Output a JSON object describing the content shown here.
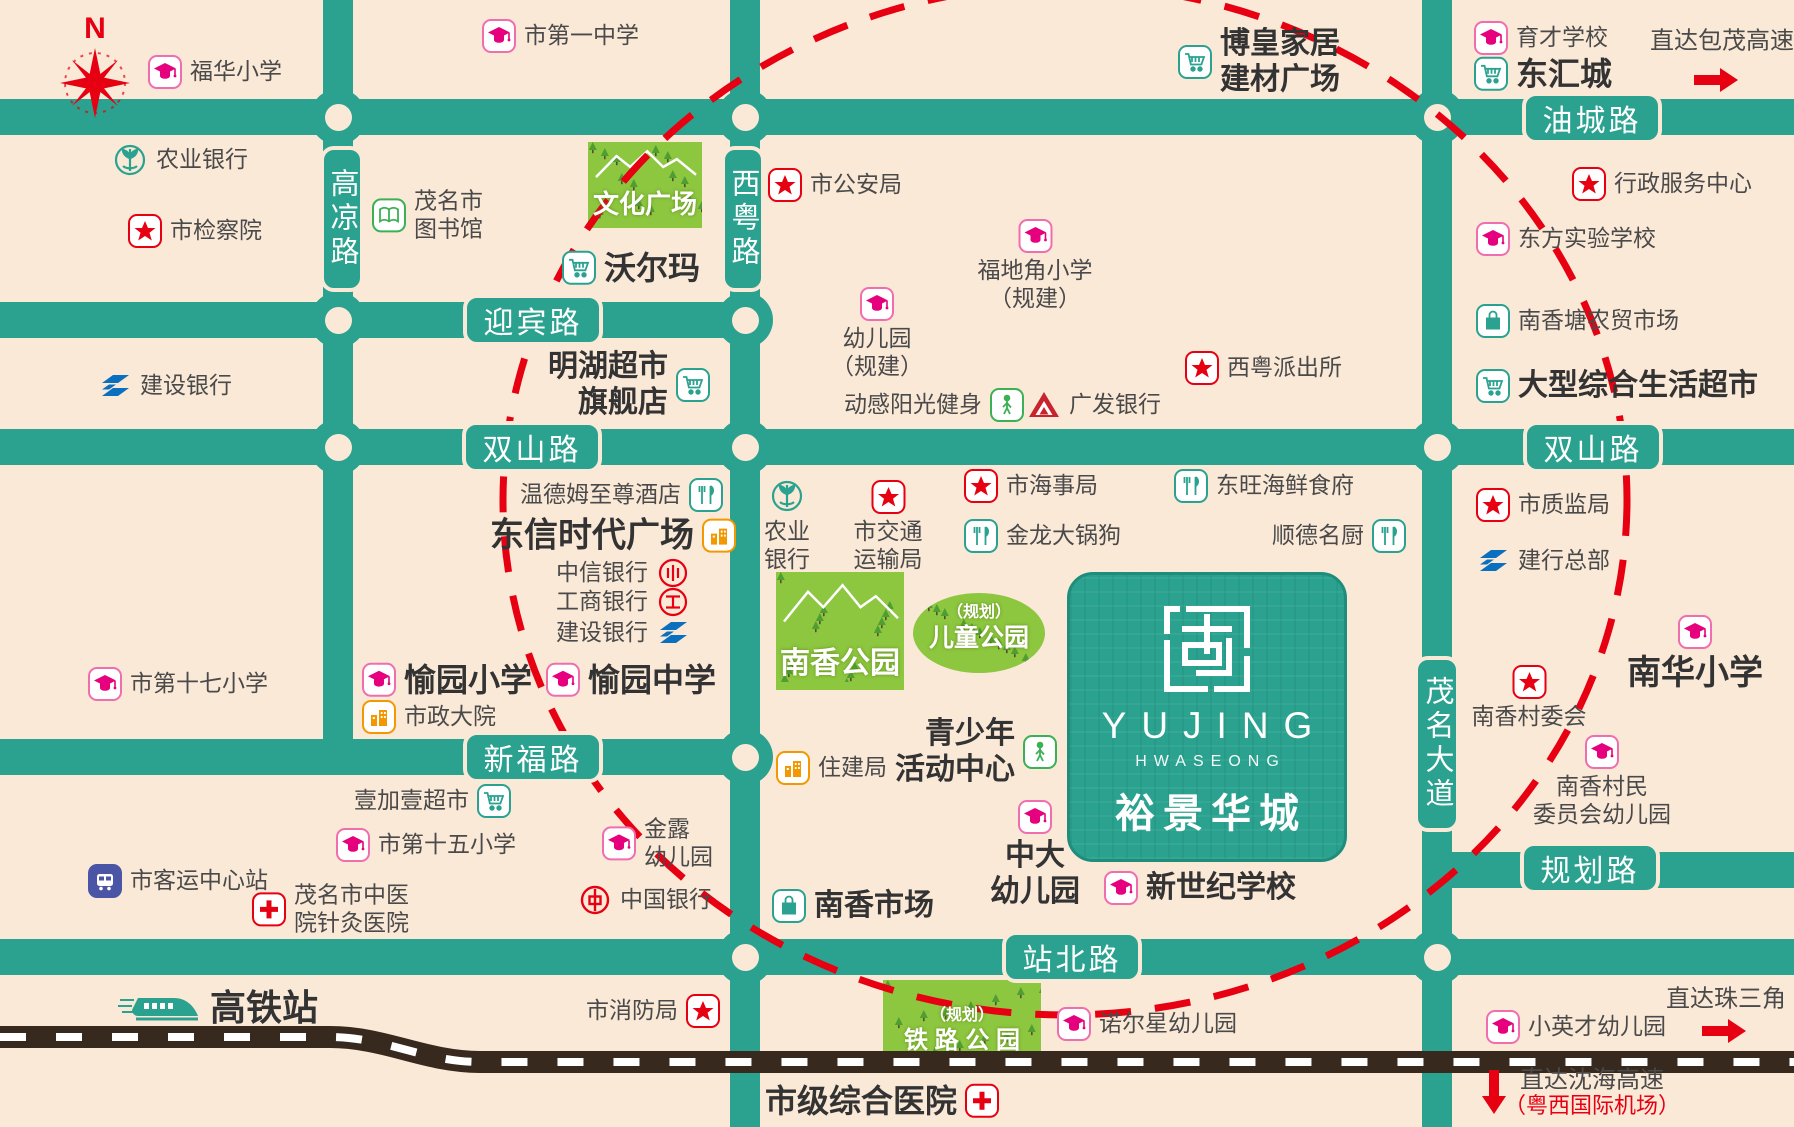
{
  "canvas": {
    "width": 1794,
    "height": 1127,
    "bg": "#fbe9d8",
    "road_color": "#2aa28f",
    "accent_red": "#e60012",
    "park_green": "#8dc63f"
  },
  "compass": {
    "label": "N"
  },
  "roads": {
    "horizontal": [
      {
        "name": "油城路",
        "x": 0,
        "y": 99,
        "w": 1794,
        "h": 36
      },
      {
        "name": "迎宾路",
        "x": 0,
        "y": 302,
        "w": 760,
        "h": 36
      },
      {
        "name": "双山路",
        "x": 0,
        "y": 429,
        "w": 1794,
        "h": 36
      },
      {
        "name": "新福路",
        "x": 0,
        "y": 739,
        "w": 760,
        "h": 36
      },
      {
        "name": "规划路",
        "x": 1422,
        "y": 852,
        "w": 372,
        "h": 36
      },
      {
        "name": "站北路",
        "x": 0,
        "y": 939,
        "w": 1794,
        "h": 36
      }
    ],
    "vertical": [
      {
        "name": "高凉路",
        "x": 323,
        "y": 0,
        "w": 30,
        "h": 775
      },
      {
        "name": "西粤路",
        "x": 730,
        "y": 0,
        "w": 30,
        "h": 1127
      },
      {
        "name": "茂名大道",
        "x": 1422,
        "y": 0,
        "w": 30,
        "h": 1127
      }
    ]
  },
  "road_badges": [
    {
      "label": "油城路",
      "x": 1522,
      "y": 92,
      "w": 140,
      "h": 52,
      "vertical": false
    },
    {
      "label": "迎宾路",
      "x": 463,
      "y": 294,
      "w": 140,
      "h": 52,
      "vertical": false
    },
    {
      "label": "双山路",
      "x": 462,
      "y": 421,
      "w": 140,
      "h": 52,
      "vertical": false
    },
    {
      "label": "双山路",
      "x": 1523,
      "y": 421,
      "w": 140,
      "h": 52,
      "vertical": false
    },
    {
      "label": "新福路",
      "x": 463,
      "y": 731,
      "w": 140,
      "h": 52,
      "vertical": false
    },
    {
      "label": "规划路",
      "x": 1520,
      "y": 842,
      "w": 140,
      "h": 52,
      "vertical": false
    },
    {
      "label": "站北路",
      "x": 1002,
      "y": 931,
      "w": 140,
      "h": 52,
      "vertical": false
    },
    {
      "label": "高凉路",
      "x": 320,
      "y": 146,
      "w": 44,
      "h": 146,
      "vertical": true
    },
    {
      "label": "西粤路",
      "x": 721,
      "y": 146,
      "w": 44,
      "h": 146,
      "vertical": true
    },
    {
      "label": "茂名大道",
      "x": 1414,
      "y": 656,
      "w": 46,
      "h": 176,
      "vertical": true
    }
  ],
  "junctions": [
    [
      338,
      117
    ],
    [
      745,
      117
    ],
    [
      1437,
      117
    ],
    [
      338,
      320
    ],
    [
      745,
      320
    ],
    [
      338,
      447
    ],
    [
      745,
      447
    ],
    [
      1437,
      447
    ],
    [
      745,
      757
    ],
    [
      745,
      957
    ],
    [
      1437,
      957
    ]
  ],
  "highlight_circle": {
    "cx": 1065,
    "cy": 500,
    "rx": 562,
    "ry": 515
  },
  "railway": {
    "path": "M0,1037 H330 C385,1037 425,1062 480,1062 H1794"
  },
  "parks": [
    {
      "name": "culture-square-park",
      "shape": "rect",
      "x": 588,
      "y": 142,
      "w": 114,
      "h": 78,
      "lines": [
        "文化广场"
      ],
      "sizes": [
        26
      ],
      "mountains": true
    },
    {
      "name": "nanxiang-park",
      "shape": "rect",
      "x": 776,
      "y": 572,
      "w": 128,
      "h": 110,
      "lines": [
        "南香公园"
      ],
      "sizes": [
        30
      ],
      "mountains": true
    },
    {
      "name": "children-park-planned",
      "shape": "ellipse",
      "x": 913,
      "y": 593,
      "w": 132,
      "h": 72,
      "lines": [
        "（规划）",
        "儿童公园"
      ],
      "sizes": [
        16,
        25
      ],
      "mountains": false
    },
    {
      "name": "railway-park-planned",
      "shape": "rect",
      "x": 883,
      "y": 980,
      "w": 158,
      "h": 76,
      "lines": [
        "（规划）",
        "铁 路 公 园"
      ],
      "sizes": [
        16,
        24
      ],
      "mountains": false
    }
  ],
  "project_block": {
    "x": 1067,
    "y": 572,
    "w": 274,
    "h": 284,
    "en": "YUJING",
    "sub": "HWASEONG",
    "cn": "裕景华城"
  },
  "markers": [
    {
      "name": "poi-fuhua-primary",
      "icon": "school",
      "layout": "row",
      "x": 148,
      "y": 72,
      "lines": [
        "福华小学"
      ]
    },
    {
      "name": "poi-no1-middle-school",
      "icon": "school",
      "layout": "row",
      "x": 482,
      "y": 36,
      "lines": [
        "市第一中学"
      ]
    },
    {
      "name": "poi-bohuang-home-plaza",
      "icon": "cart",
      "layout": "row",
      "x": 1178,
      "y": 62,
      "bold": true,
      "lines": [
        "博皇家居",
        "建材广场"
      ]
    },
    {
      "name": "poi-yucai-school",
      "icon": "school",
      "layout": "row",
      "x": 1474,
      "y": 38,
      "lines": [
        "育才学校"
      ]
    },
    {
      "name": "poi-donghui-city",
      "icon": "cart",
      "layout": "row",
      "x": 1474,
      "y": 74,
      "bold": true,
      "size": 32,
      "lines": [
        "东汇城"
      ]
    },
    {
      "name": "note-baomao-expressway",
      "icon": null,
      "layout": "row",
      "x": 1650,
      "y": 42,
      "size": 24,
      "lines": [
        "直达包茂高速"
      ]
    },
    {
      "name": "arrow-baomao",
      "icon": "arrow-right",
      "layout": "row",
      "x": 1692,
      "y": 80,
      "lines": []
    },
    {
      "name": "poi-abc-bank-1",
      "icon": "abc",
      "layout": "row",
      "x": 112,
      "y": 160,
      "lines": [
        "农业银行"
      ]
    },
    {
      "name": "poi-procuratorate",
      "icon": "star",
      "layout": "row",
      "x": 128,
      "y": 231,
      "lines": [
        "市检察院"
      ]
    },
    {
      "name": "poi-maoming-library",
      "icon": "book",
      "layout": "row",
      "x": 372,
      "y": 215,
      "lines": [
        "茂名市",
        "图书馆"
      ]
    },
    {
      "name": "poi-public-security-bureau",
      "icon": "star",
      "layout": "row",
      "x": 768,
      "y": 185,
      "lines": [
        "市公安局"
      ]
    },
    {
      "name": "poi-walmart",
      "icon": "cart",
      "layout": "row",
      "x": 562,
      "y": 268,
      "bold": true,
      "size": 32,
      "lines": [
        "沃尔玛"
      ]
    },
    {
      "name": "poi-minghu-supermarket",
      "icon": "cart",
      "layout": "row-rev",
      "x": 548,
      "y": 385,
      "bold": true,
      "align": "right",
      "lines": [
        "明湖超市",
        "旗舰店"
      ]
    },
    {
      "name": "poi-kindergarten-planned",
      "icon": "school",
      "layout": "col",
      "x": 877,
      "y": 287,
      "lines": [
        "幼儿园",
        "（规建）"
      ]
    },
    {
      "name": "poi-fudijiao-primary-planned",
      "icon": "school",
      "layout": "col",
      "x": 1035,
      "y": 219,
      "lines": [
        "福地角小学",
        "（规建）"
      ]
    },
    {
      "name": "poi-xiyue-police-station",
      "icon": "star",
      "layout": "row",
      "x": 1185,
      "y": 368,
      "lines": [
        "西粤派出所"
      ]
    },
    {
      "name": "poi-donggan-gym",
      "icon": "person",
      "layout": "row-rev",
      "x": 844,
      "y": 405,
      "lines": [
        "动感阳光健身"
      ]
    },
    {
      "name": "poi-cgb-bank",
      "icon": "cgb",
      "layout": "row",
      "x": 1027,
      "y": 405,
      "lines": [
        "广发银行"
      ]
    },
    {
      "name": "poi-admin-service-center",
      "icon": "star",
      "layout": "row",
      "x": 1572,
      "y": 184,
      "lines": [
        "行政服务中心"
      ]
    },
    {
      "name": "poi-dongfang-experimental-school",
      "icon": "school",
      "layout": "row",
      "x": 1476,
      "y": 239,
      "lines": [
        "东方实验学校"
      ]
    },
    {
      "name": "poi-nanxiangtang-market",
      "icon": "bag",
      "layout": "row",
      "x": 1476,
      "y": 321,
      "lines": [
        "南香塘农贸市场"
      ]
    },
    {
      "name": "poi-large-supermarket",
      "icon": "cart",
      "layout": "row",
      "x": 1476,
      "y": 386,
      "bold": true,
      "lines": [
        "大型综合生活超市"
      ]
    },
    {
      "name": "poi-wyndham-hotel",
      "icon": "rest",
      "layout": "row-rev",
      "x": 520,
      "y": 495,
      "lines": [
        "温德姆至尊酒店"
      ]
    },
    {
      "name": "poi-dongxin-plaza",
      "icon": "building",
      "layout": "row-rev",
      "x": 490,
      "y": 536,
      "bold": true,
      "size": 34,
      "lines": [
        "东信时代广场"
      ]
    },
    {
      "name": "poi-citic-bank",
      "icon": "citic",
      "layout": "row-rev",
      "x": 556,
      "y": 573,
      "lines": [
        "中信银行"
      ]
    },
    {
      "name": "poi-icbc-bank",
      "icon": "icbc",
      "layout": "row-rev",
      "x": 556,
      "y": 602,
      "lines": [
        "工商银行"
      ]
    },
    {
      "name": "poi-ccb-bank-2",
      "icon": "ccb",
      "layout": "row-rev",
      "x": 556,
      "y": 633,
      "lines": [
        "建设银行"
      ]
    },
    {
      "name": "poi-ccb-bank-1",
      "icon": "ccb",
      "layout": "row",
      "x": 98,
      "y": 386,
      "lines": [
        "建设银行"
      ]
    },
    {
      "name": "poi-yuyuan-primary",
      "icon": "school",
      "layout": "row",
      "x": 362,
      "y": 680,
      "bold": true,
      "size": 32,
      "lines": [
        "愉园小学"
      ]
    },
    {
      "name": "poi-yuyuan-middle",
      "icon": "school",
      "layout": "row",
      "x": 546,
      "y": 680,
      "bold": true,
      "size": 32,
      "lines": [
        "愉园中学"
      ]
    },
    {
      "name": "poi-municipal-compound",
      "icon": "building",
      "layout": "row",
      "x": 362,
      "y": 717,
      "lines": [
        "市政大院"
      ]
    },
    {
      "name": "poi-no17-primary",
      "icon": "school",
      "layout": "row",
      "x": 88,
      "y": 684,
      "lines": [
        "市第十七小学"
      ]
    },
    {
      "name": "poi-passenger-station",
      "icon": "bus",
      "layout": "row",
      "x": 88,
      "y": 881,
      "lines": [
        "市客运中心站"
      ]
    },
    {
      "name": "poi-tcm-acupuncture-hospital",
      "icon": "cross",
      "layout": "row",
      "x": 252,
      "y": 909,
      "lines": [
        "茂名市中医",
        "院针灸医院"
      ]
    },
    {
      "name": "poi-yijiayi-supermarket",
      "icon": "cart",
      "layout": "row-rev",
      "x": 354,
      "y": 801,
      "lines": [
        "壹加壹超市"
      ]
    },
    {
      "name": "poi-no15-primary",
      "icon": "school",
      "layout": "row",
      "x": 336,
      "y": 845,
      "lines": [
        "市第十五小学"
      ]
    },
    {
      "name": "poi-jinlu-kindergarten",
      "icon": "school",
      "layout": "row",
      "x": 602,
      "y": 843,
      "lines": [
        "金露",
        "幼儿园"
      ]
    },
    {
      "name": "poi-bank-of-china",
      "icon": "boc",
      "layout": "row",
      "x": 578,
      "y": 900,
      "lines": [
        "中国银行"
      ]
    },
    {
      "name": "poi-housing-bureau",
      "icon": "building",
      "layout": "row",
      "x": 776,
      "y": 768,
      "lines": [
        "住建局"
      ]
    },
    {
      "name": "poi-youth-activity-center",
      "icon": "person",
      "layout": "row-rev",
      "x": 895,
      "y": 752,
      "bold": true,
      "align": "right",
      "lines": [
        "青少年",
        "活动中心"
      ]
    },
    {
      "name": "poi-zhongda-kindergarten",
      "icon": "school",
      "layout": "col",
      "x": 1035,
      "y": 800,
      "bold": true,
      "lines": [
        "中大",
        "幼儿园"
      ]
    },
    {
      "name": "poi-new-century-school",
      "icon": "school",
      "layout": "row",
      "x": 1104,
      "y": 888,
      "bold": true,
      "lines": [
        "新世纪学校"
      ]
    },
    {
      "name": "poi-nanxiang-market",
      "icon": "bag",
      "layout": "row",
      "x": 772,
      "y": 906,
      "bold": true,
      "lines": [
        "南香市场"
      ]
    },
    {
      "name": "poi-maritime-bureau",
      "icon": "star",
      "layout": "row",
      "x": 964,
      "y": 486,
      "lines": [
        "市海事局"
      ]
    },
    {
      "name": "poi-dongwang-seafood",
      "icon": "rest",
      "layout": "row",
      "x": 1174,
      "y": 486,
      "lines": [
        "东旺海鲜食府"
      ]
    },
    {
      "name": "poi-jinlong-restaurant",
      "icon": "rest",
      "layout": "row",
      "x": 964,
      "y": 536,
      "lines": [
        "金龙大锅狗"
      ]
    },
    {
      "name": "poi-shunde-chef",
      "icon": "rest",
      "layout": "row-rev",
      "x": 1272,
      "y": 536,
      "lines": [
        "顺德名厨"
      ]
    },
    {
      "name": "poi-transport-bureau",
      "icon": "star",
      "layout": "col",
      "x": 888,
      "y": 480,
      "lines": [
        "市交通",
        "运输局"
      ]
    },
    {
      "name": "poi-abc-bank-2",
      "icon": "abc",
      "layout": "col",
      "x": 787,
      "y": 478,
      "lines": [
        "农业",
        "银行"
      ]
    },
    {
      "name": "poi-quality-bureau",
      "icon": "star",
      "layout": "row",
      "x": 1476,
      "y": 505,
      "lines": [
        "市质监局"
      ]
    },
    {
      "name": "poi-ccb-headquarters",
      "icon": "ccb",
      "layout": "row",
      "x": 1476,
      "y": 561,
      "lines": [
        "建行总部"
      ]
    },
    {
      "name": "poi-nanhua-primary",
      "icon": "school",
      "layout": "col",
      "x": 1695,
      "y": 615,
      "bold": true,
      "size": 34,
      "lines": [
        "南华小学"
      ]
    },
    {
      "name": "poi-nanxiang-village-committee",
      "icon": "star",
      "layout": "col",
      "x": 1529,
      "y": 665,
      "lines": [
        "南香村委会"
      ]
    },
    {
      "name": "poi-village-kindergarten",
      "icon": "school",
      "layout": "col",
      "x": 1602,
      "y": 735,
      "lines": [
        "南香村民",
        "委员会幼儿园"
      ]
    },
    {
      "name": "poi-high-speed-rail-station",
      "icon": "train",
      "layout": "row",
      "x": 118,
      "y": 1008,
      "bold": true,
      "size": 36,
      "lines": [
        "高铁站"
      ]
    },
    {
      "name": "poi-fire-bureau",
      "icon": "star",
      "layout": "row-rev",
      "x": 586,
      "y": 1011,
      "lines": [
        "市消防局"
      ]
    },
    {
      "name": "poi-nuoerxing-kindergarten",
      "icon": "school",
      "layout": "row",
      "x": 1057,
      "y": 1024,
      "lines": [
        "诺尔星幼儿园"
      ]
    },
    {
      "name": "poi-city-general-hospital",
      "icon": "cross",
      "layout": "row-rev",
      "x": 765,
      "y": 1101,
      "bold": true,
      "size": 32,
      "lines": [
        "市级综合医院"
      ]
    },
    {
      "name": "poi-xiaoyingcai-kindergarten",
      "icon": "school",
      "layout": "row",
      "x": 1486,
      "y": 1027,
      "lines": [
        "小英才幼儿园"
      ]
    },
    {
      "name": "note-pearl-delta",
      "icon": null,
      "layout": "row",
      "x": 1666,
      "y": 1000,
      "size": 24,
      "lines": [
        "直达珠三角"
      ]
    },
    {
      "name": "arrow-pearl-delta",
      "icon": "arrow-right",
      "layout": "row",
      "x": 1700,
      "y": 1031,
      "lines": []
    },
    {
      "name": "arrow-shenhai",
      "icon": "arrow-down",
      "layout": "row",
      "x": 1478,
      "y": 1091,
      "lines": []
    },
    {
      "name": "note-shenhai-expressway",
      "icon": null,
      "layout": "row",
      "x": 1520,
      "y": 1081,
      "size": 24,
      "lines": [
        "直达沈海高速"
      ]
    },
    {
      "name": "note-yuexi-airport",
      "icon": null,
      "layout": "row",
      "x": 1504,
      "y": 1106,
      "size": 22,
      "color": "#e60012",
      "lines": [
        "（粤西国际机场）"
      ]
    }
  ]
}
